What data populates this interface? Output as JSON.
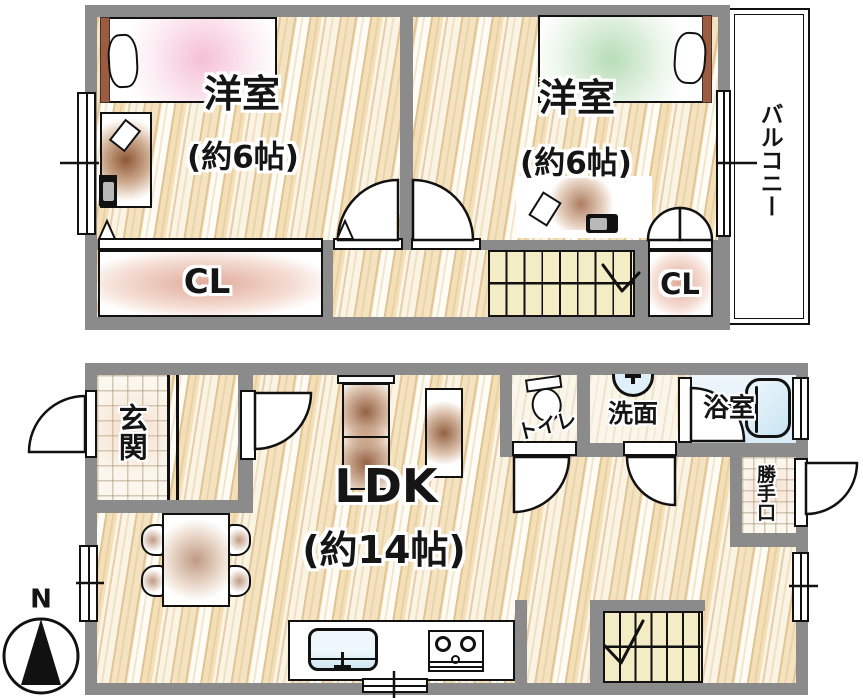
{
  "floor2": {
    "room1_name": "洋室",
    "room1_size": "(約6帖)",
    "room2_name": "洋室",
    "room2_size": "(約6帖)",
    "balcony": "バルコニー",
    "closet_left": "CL",
    "closet_right": "CL"
  },
  "floor1": {
    "entrance": "玄関",
    "ldk_name": "LDK",
    "ldk_size": "(約14帖)",
    "toilet": "トイレ",
    "washroom": "洗面",
    "bathroom": "浴室",
    "back_door": "勝手口"
  },
  "compass": {
    "north": "N"
  },
  "colors": {
    "wall": "#8b8b8b",
    "wood_floor": "#f8efdb",
    "stairs": "#f4ecc5",
    "water_blue": "#d6ebf5",
    "furniture_brown": "#a8653a",
    "bed_pink": "#f3c9d8",
    "bed_green": "#cfe6cb",
    "headboard_brown": "#9d5c40"
  }
}
